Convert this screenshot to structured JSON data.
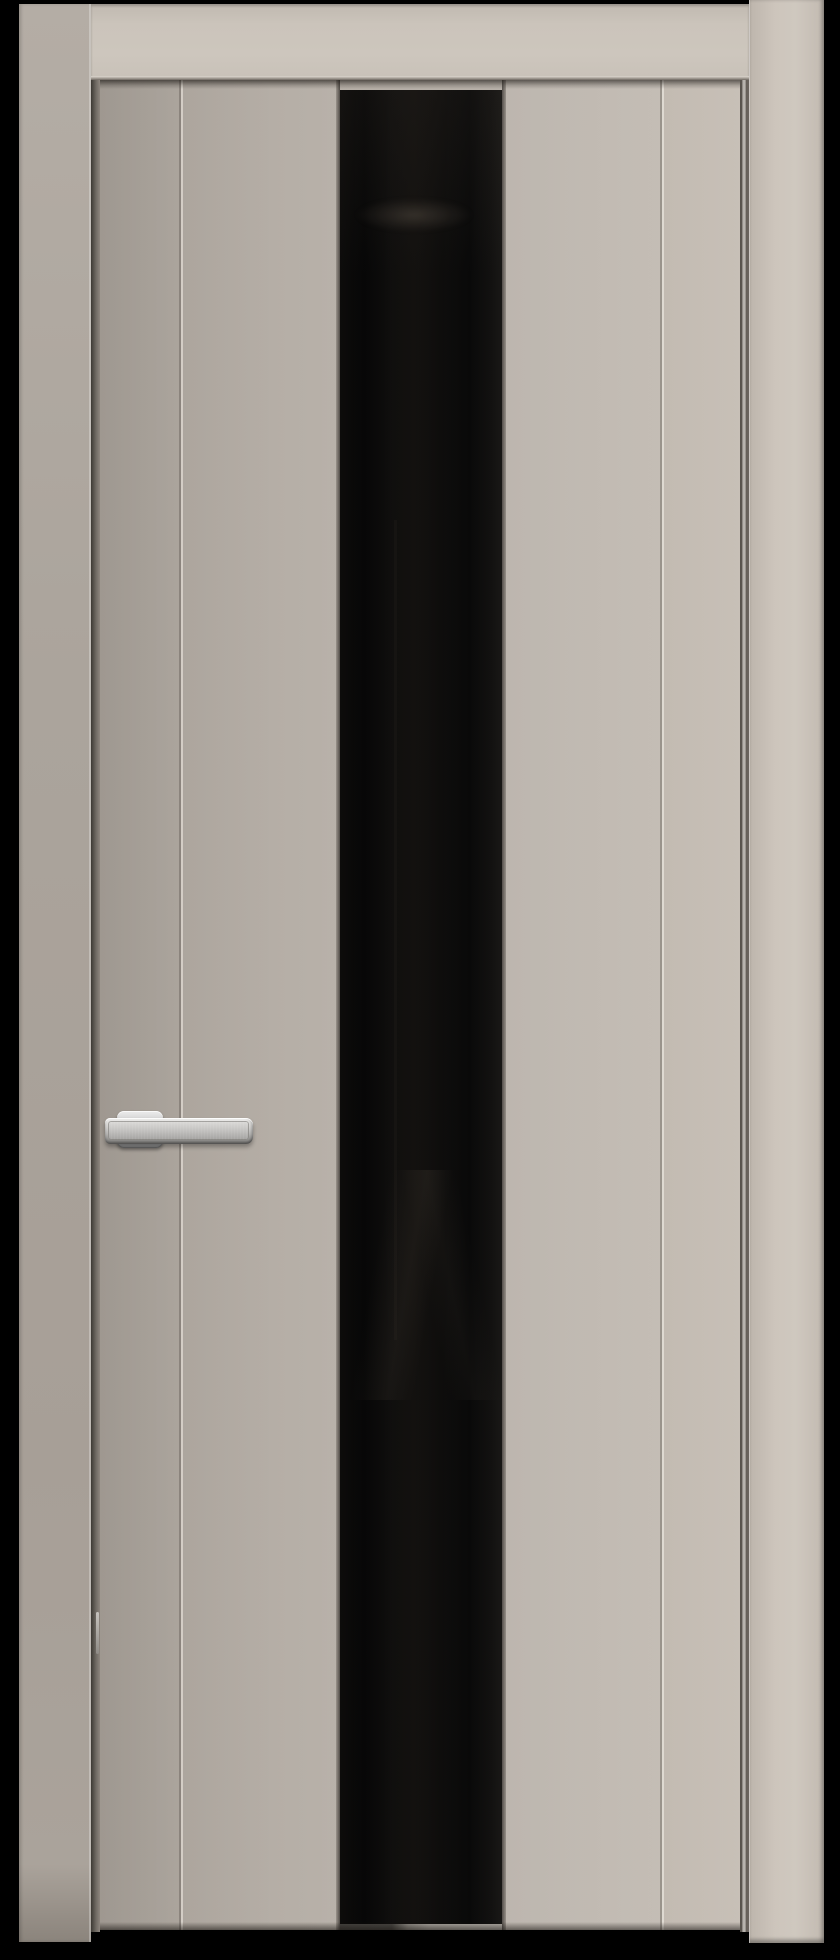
{
  "scene": {
    "objects": [
      "door-frame",
      "door-leaf",
      "black-glass-insert",
      "lever-handle"
    ]
  },
  "colors": {
    "background": "#000000",
    "casing_left": "#aba49c",
    "casing_right": "#cdc5bc",
    "top_rail": "#cbc4bb",
    "leaf_panel": "#b5aea6",
    "leaf_stile_left": "#aca59d",
    "leaf_panel_left": "#b4ada5",
    "leaf_panel_right": "#bfb8b0",
    "leaf_stile_right": "#c2bab1",
    "groove_highlight": "#d9d3cb",
    "groove_shadow": "#8f8881",
    "gap_shadow": "#57524c",
    "jamb_strip_silver": "#c8c4bf",
    "glass_black": "#060606",
    "glass_reflection": "#2d2a26",
    "sill_highlight": "#aaa59e",
    "handle_light": "#ececec",
    "handle_mid": "#b5b4b2",
    "handle_dark": "#848484"
  }
}
